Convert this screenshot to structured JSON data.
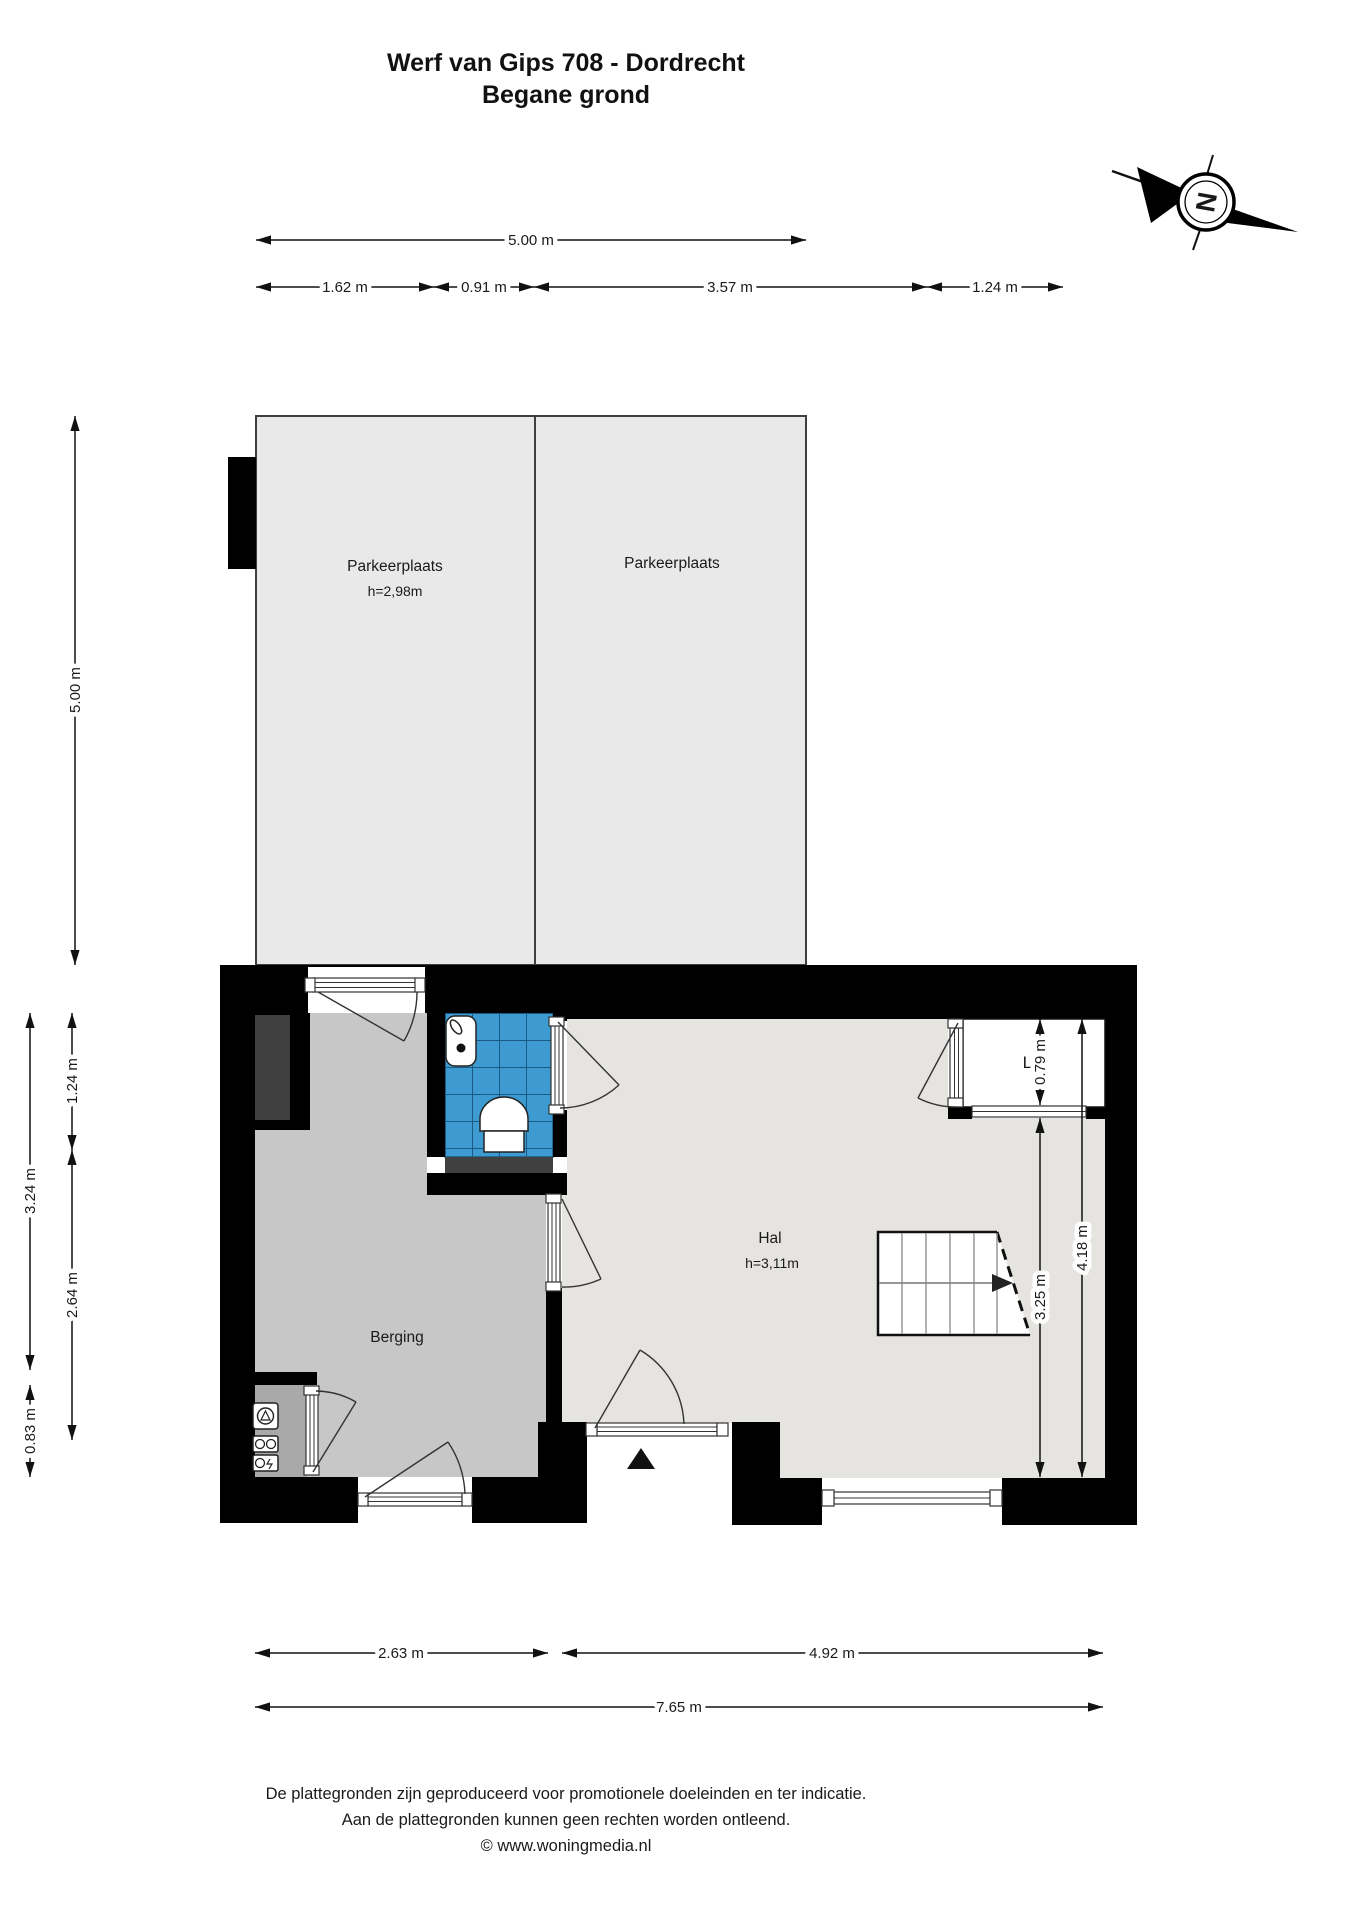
{
  "title": {
    "line1": "Werf van Gips 708 - Dordrecht",
    "line2": "Begane grond"
  },
  "compass": {
    "label": "N"
  },
  "rooms": {
    "parking_left": {
      "name": "Parkeerplaats",
      "height": "h=2,98m"
    },
    "parking_right": {
      "name": "Parkeerplaats"
    },
    "berging": {
      "name": "Berging"
    },
    "hal": {
      "name": "Hal",
      "height": "h=3,11m"
    },
    "lift": {
      "name": "Lift"
    }
  },
  "dims": {
    "top_total": "5.00 m",
    "top_1": "1.62 m",
    "top_2": "0.91 m",
    "top_3": "3.57 m",
    "top_4": "1.24 m",
    "left_1": "5.00 m",
    "left_2": "1.24 m",
    "left_3": "3.24 m",
    "left_4": "2.64 m",
    "left_5": "0.83 m",
    "right_1": "0.79 m",
    "right_2": "3.25 m",
    "right_3": "4.18 m",
    "bottom_1": "2.63 m",
    "bottom_2": "4.92 m",
    "bottom_3": "7.65 m"
  },
  "footer": {
    "line1": "De plattegronden zijn geproduceerd voor promotionele doeleinden en ter indicatie.",
    "line2": "Aan de plattegronden kunnen geen rechten worden ontleend.",
    "line3": "© www.woningmedia.nl"
  },
  "colors": {
    "wall": "#000000",
    "parking_floor": "#e9e9e9",
    "berging_floor": "#c7c7c7",
    "hal_floor": "#e6e4e0",
    "niche_floor": "#a9a9a9",
    "shaft": "#3f3f3f",
    "toilet_tile": "#3d9bd1",
    "toilet_tile_line": "#1b5a82",
    "threshold": "#404040"
  }
}
